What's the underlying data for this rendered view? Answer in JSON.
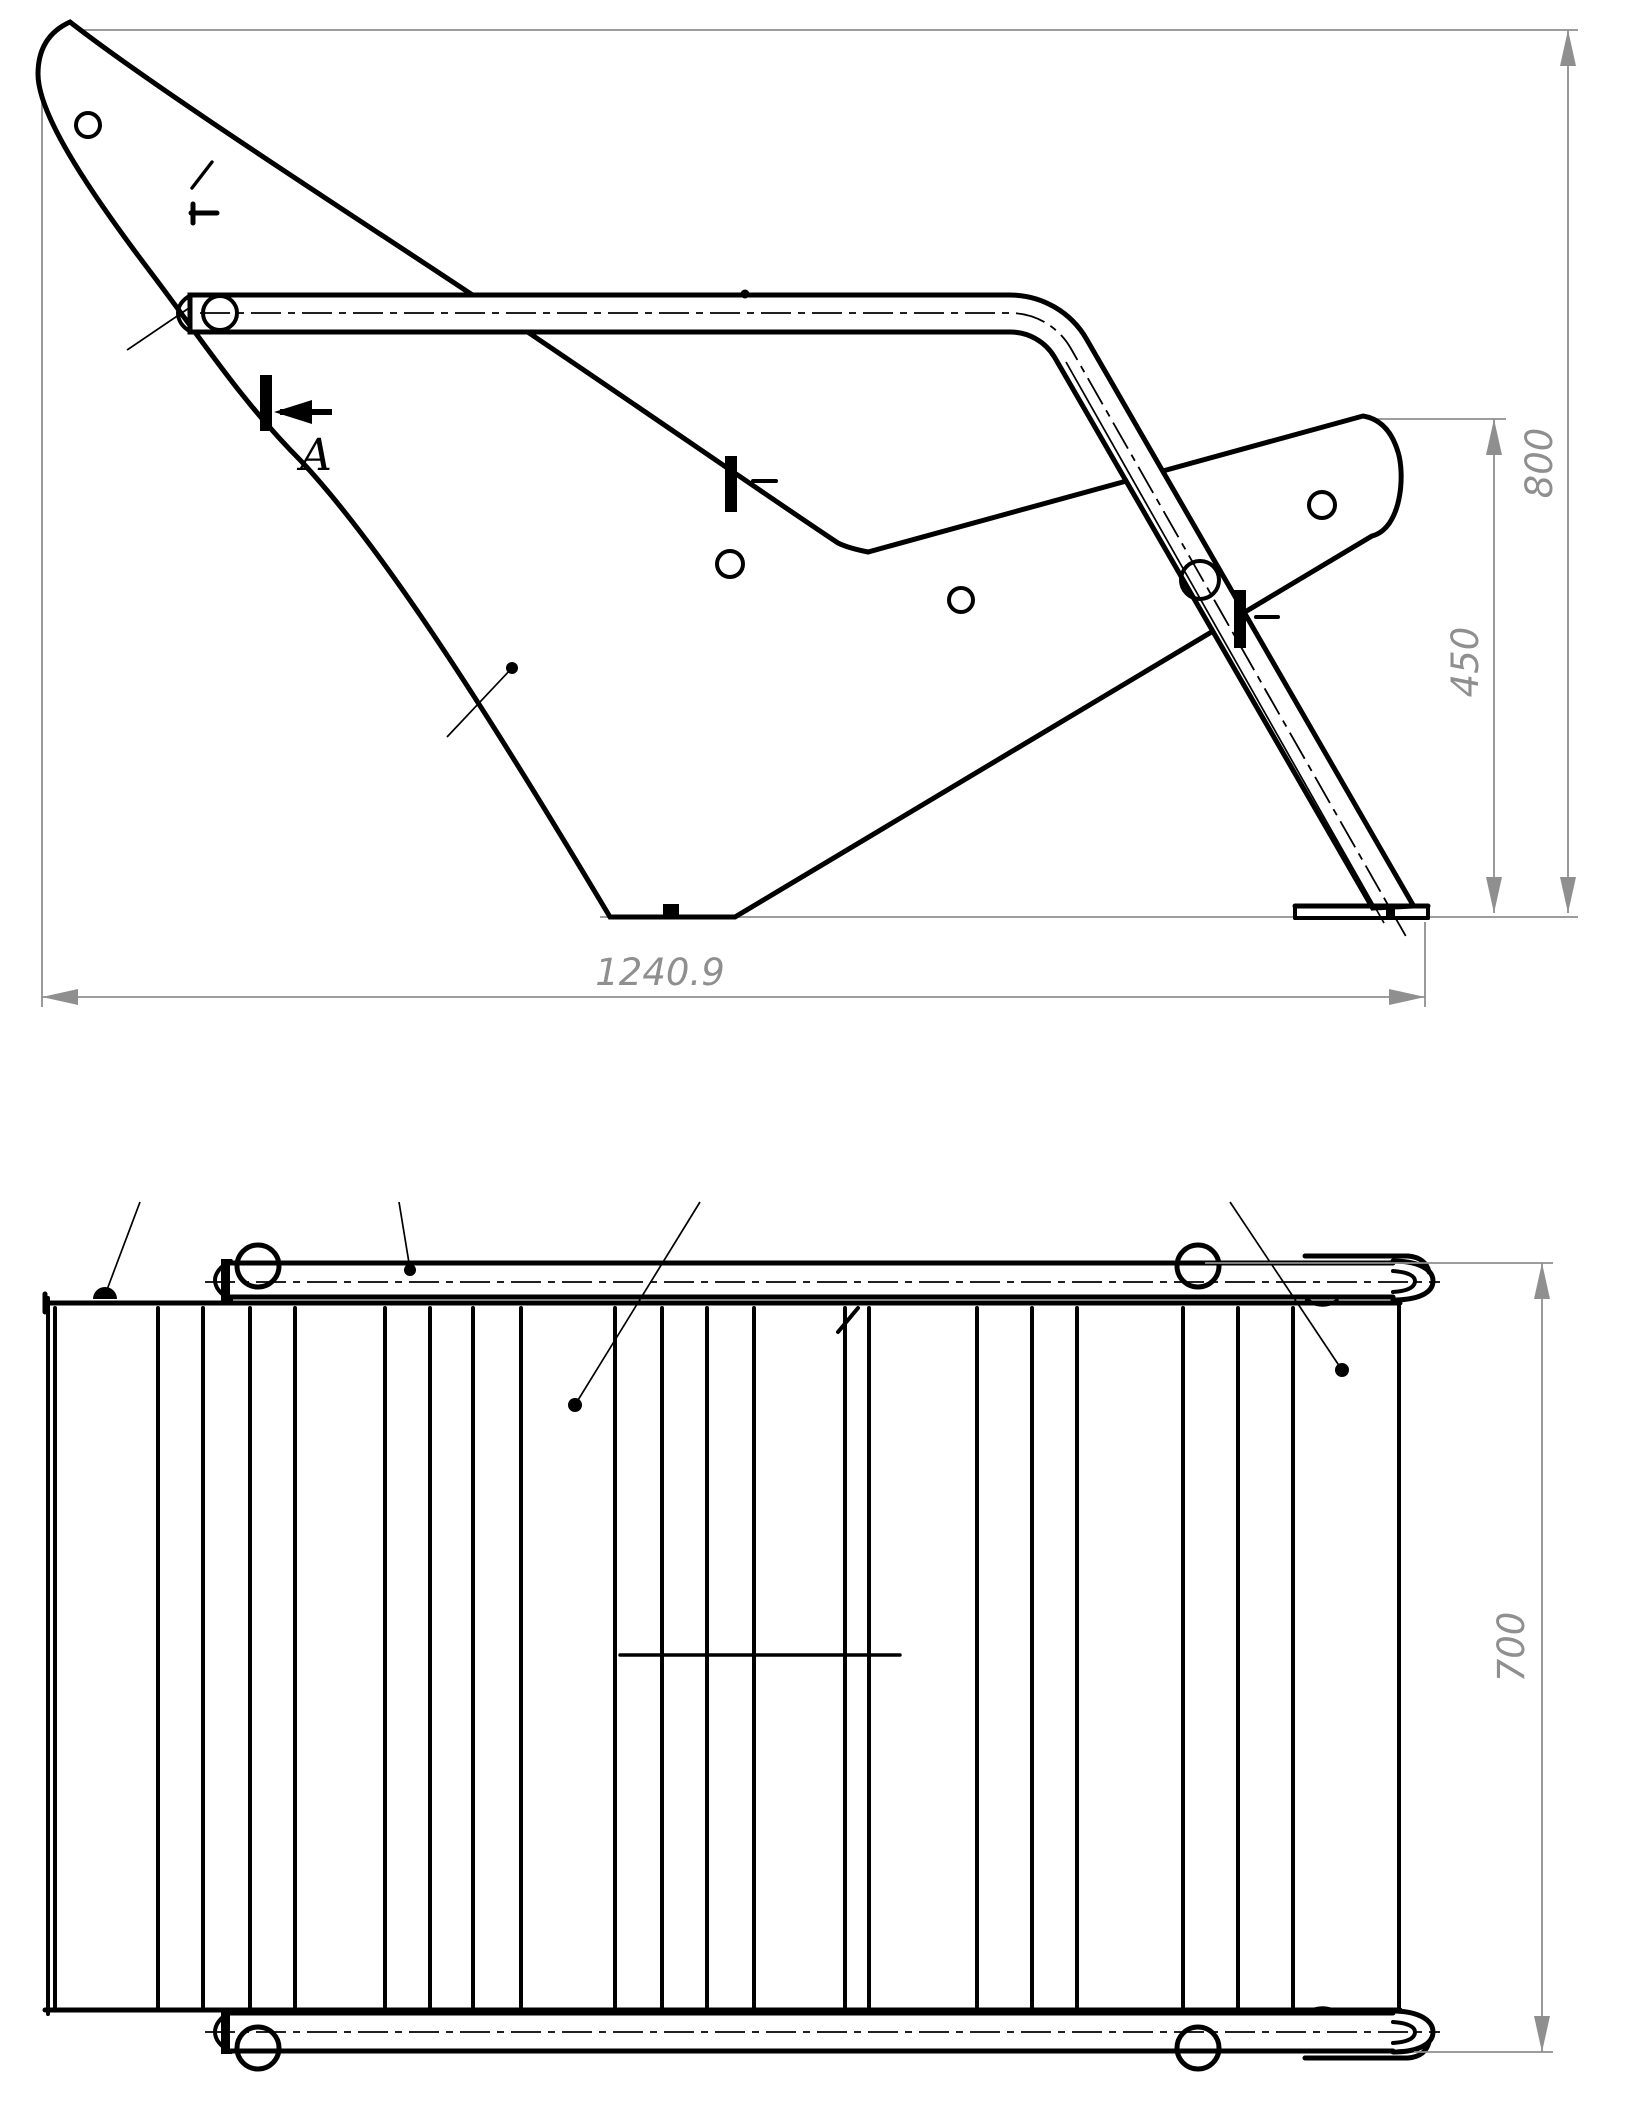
{
  "drawing": {
    "type": "technical-2-view-drawing",
    "views": {
      "side_view": {
        "name": "side elevation of bench frame",
        "dimensions": {
          "overall_length": "1240.9",
          "overall_height": "800",
          "seat_height": "450"
        },
        "section_label": "A"
      },
      "plan_view": {
        "name": "top (plan) view of bench",
        "dimensions": {
          "overall_width": "700"
        }
      }
    },
    "colors": {
      "line": "#000000",
      "dimension": "#8f8f8f",
      "background": "#ffffff"
    }
  }
}
